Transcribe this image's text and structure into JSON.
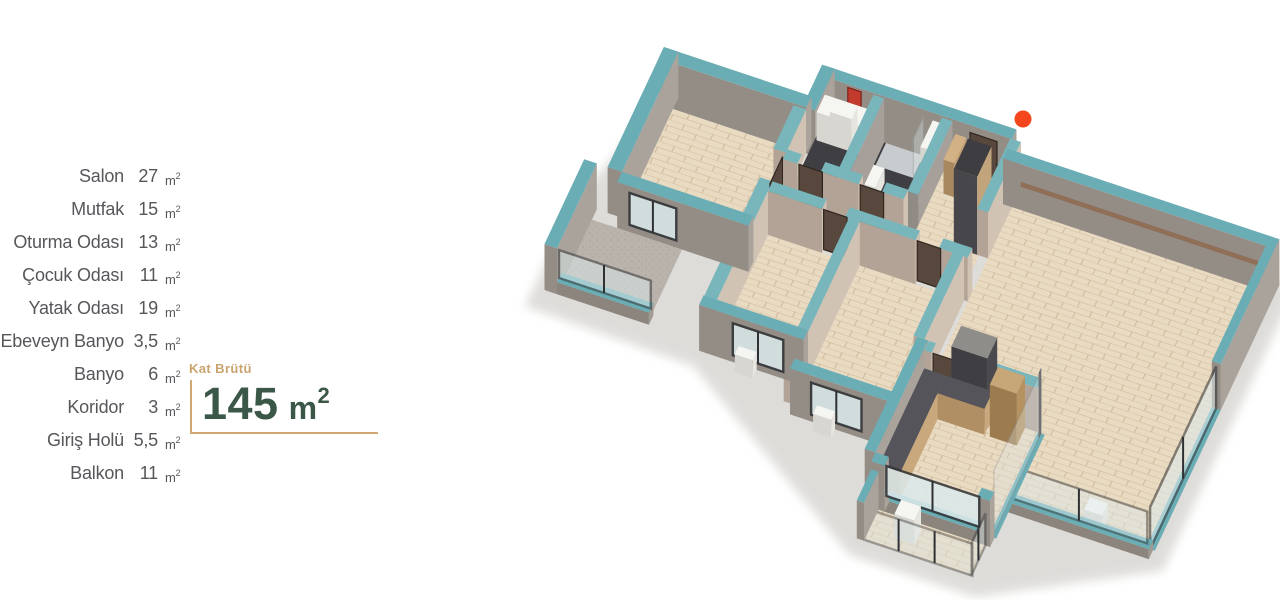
{
  "colors": {
    "accent_teal": "#6badb5",
    "marker_orange": "#f4471d",
    "title_green": "#3a5747",
    "label_tan": "#c9a46f",
    "text_gray": "#56575b",
    "wall_gray": "#a9a39b",
    "floor_wood": "#e9dac2"
  },
  "unit": {
    "symbol": "m",
    "superscript": "2"
  },
  "room_list": [
    {
      "name": "Salon",
      "area": "27"
    },
    {
      "name": "Mutfak",
      "area": "15"
    },
    {
      "name": "Oturma Odası",
      "area": "13"
    },
    {
      "name": "Çocuk Odası",
      "area": "11"
    },
    {
      "name": "Yatak Odası",
      "area": "19"
    },
    {
      "name": "Ebeveyn Banyo",
      "area": "3,5"
    },
    {
      "name": "Banyo",
      "area": "6"
    },
    {
      "name": "Koridor",
      "area": "3"
    },
    {
      "name": "Giriş Holü",
      "area": "5,5"
    },
    {
      "name": "Balkon",
      "area": "11"
    }
  ],
  "gross_area": {
    "label": "Kat Brütü",
    "value": "145"
  }
}
